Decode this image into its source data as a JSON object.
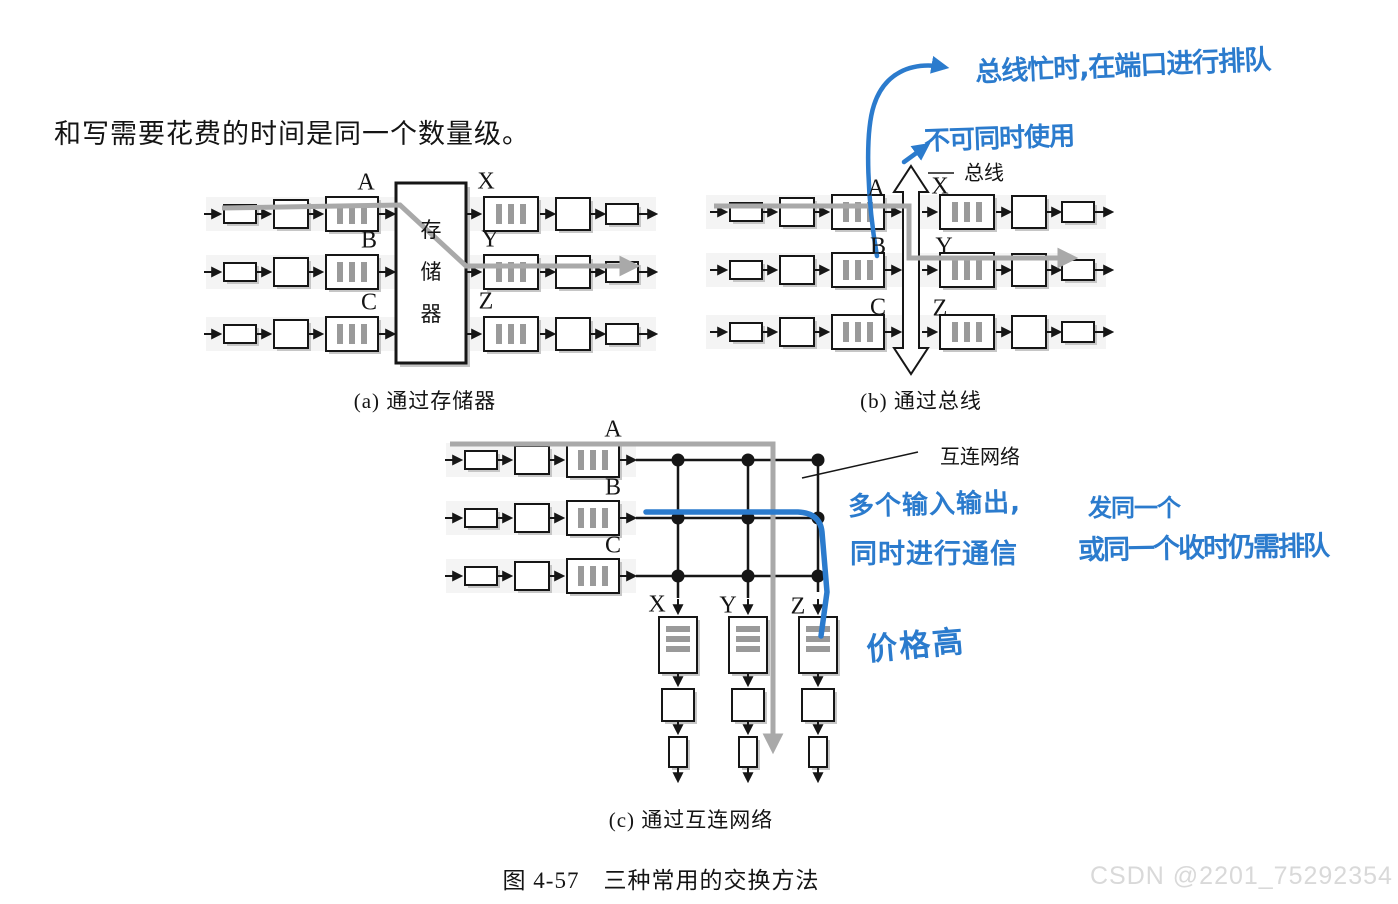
{
  "page": {
    "intro_text": "和写需要花费的时间是同一个数量级。",
    "figure_caption": "图 4-57　三种常用的交换方法",
    "watermark": "CSDN @2201_75292354"
  },
  "diagram_a": {
    "caption": "(a) 通过存储器",
    "memory_label": "存储器",
    "input_labels": [
      "A",
      "B",
      "C"
    ],
    "output_labels": [
      "X",
      "Y",
      "Z"
    ]
  },
  "diagram_b": {
    "caption": "(b) 通过总线",
    "bus_label": "总线",
    "input_labels": [
      "A",
      "B",
      "C"
    ],
    "output_labels": [
      "X",
      "Y",
      "Z"
    ]
  },
  "diagram_c": {
    "caption": "(c) 通过互连网络",
    "network_label": "互连网络",
    "input_labels": [
      "A",
      "B",
      "C"
    ],
    "output_labels": [
      "X",
      "Y",
      "Z"
    ]
  },
  "annotations": {
    "bus_queue_note": "总线忙时,在端口进行排队",
    "bus_share_note": "不可同时使用",
    "network_parallel_line1": "多个输入输出,",
    "network_parallel_line2": "同时进行通信",
    "network_queue_line1": "发同一个",
    "network_queue_line2": "或同一个收时仍需排队",
    "cost_note": "价格高"
  },
  "colors": {
    "annotation_blue": "#2b7bcd",
    "highlight_gray": "#a9a9a9",
    "watermark_gray": "#d9d9d9"
  }
}
